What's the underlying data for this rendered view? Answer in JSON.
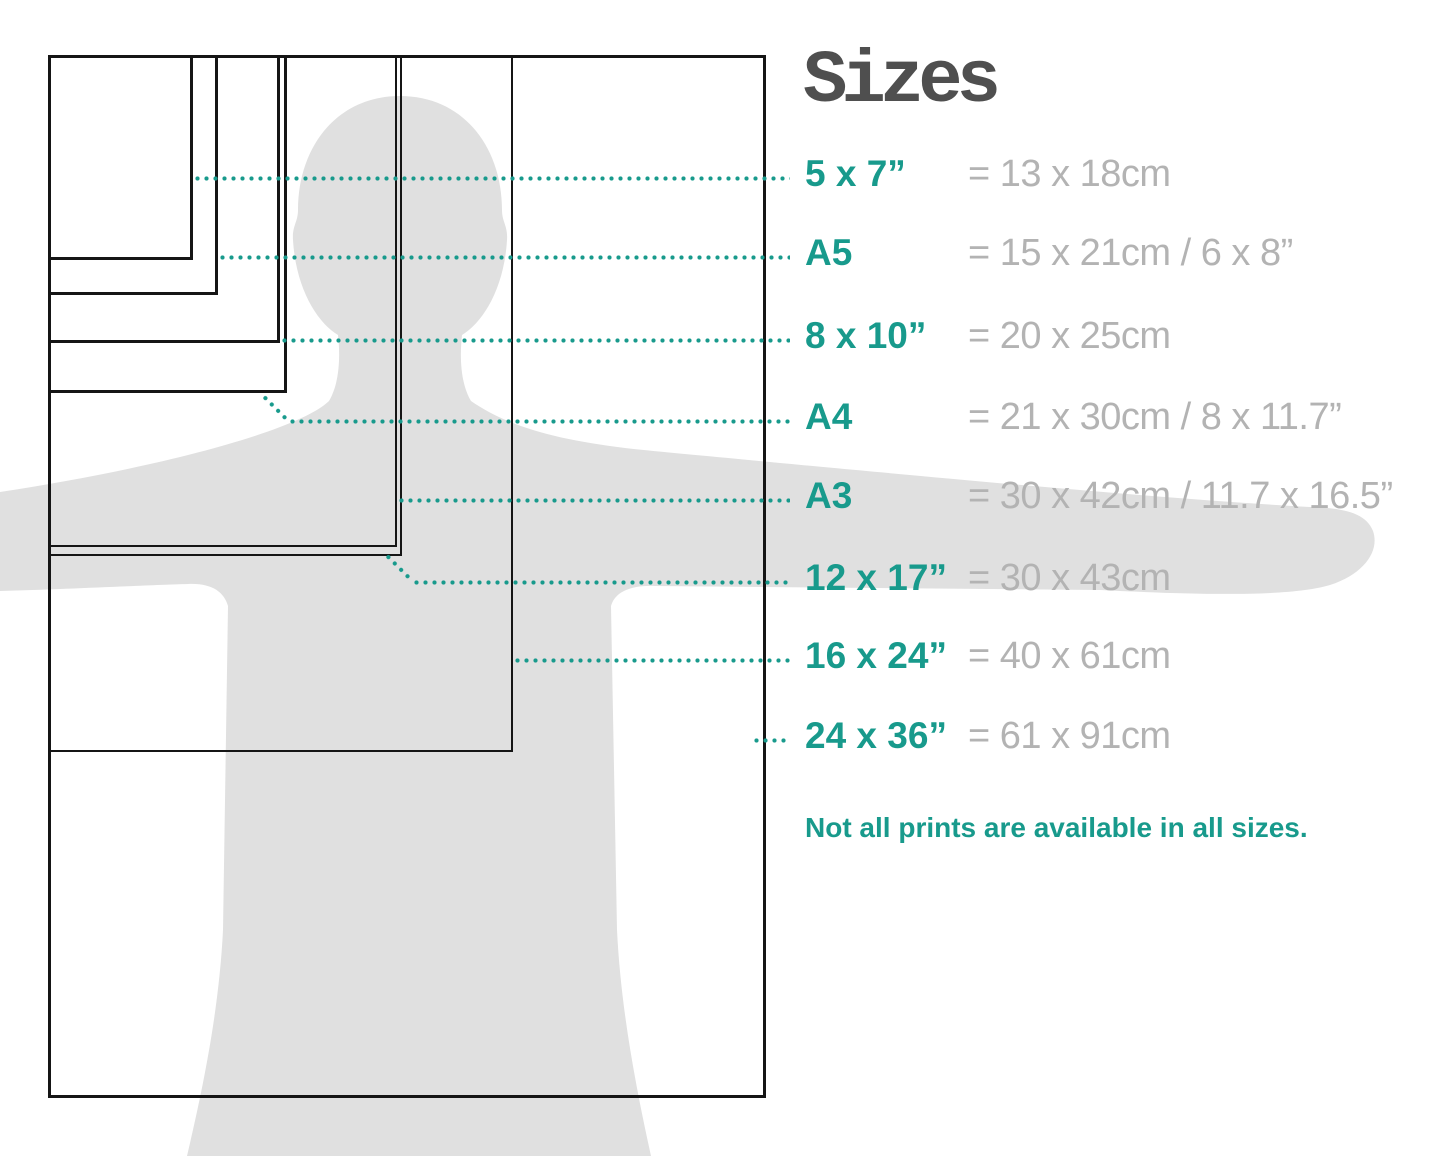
{
  "title": "Sizes",
  "note": "Not all prints are available in all sizes.",
  "colors": {
    "accent_teal": "#189a8c",
    "value_gray": "#b3b3b3",
    "title_gray": "#4f4f4f",
    "silhouette_gray": "#e0e0e0",
    "rectangle_border": "#151515"
  },
  "sizes": [
    {
      "id": "5x7",
      "label": "5 x 7”",
      "equiv": "= 13 x 18cm"
    },
    {
      "id": "a5",
      "label": "A5",
      "equiv": "= 15 x 21cm / 6 x 8”"
    },
    {
      "id": "8x10",
      "label": "8 x 10”",
      "equiv": "= 20 x 25cm"
    },
    {
      "id": "a4",
      "label": "A4",
      "equiv": "= 21 x 30cm / 8 x 11.7”"
    },
    {
      "id": "a3",
      "label": "A3",
      "equiv": "= 30 x 42cm / 11.7 x 16.5”"
    },
    {
      "id": "12x17",
      "label": "12 x 17”",
      "equiv": "= 30 x 43cm"
    },
    {
      "id": "16x24",
      "label": "16 x 24”",
      "equiv": "= 40 x 61cm"
    },
    {
      "id": "24x36",
      "label": "24 x 36”",
      "equiv": "= 61 x 91cm"
    }
  ]
}
